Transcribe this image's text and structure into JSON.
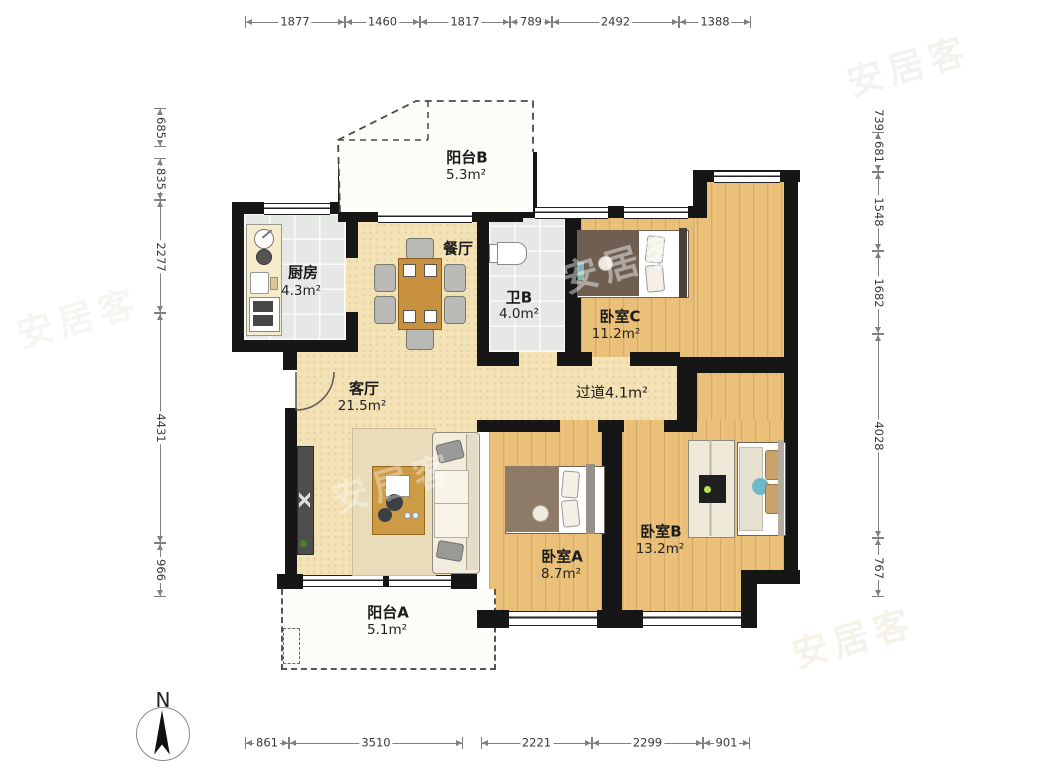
{
  "title": "三室两厅户型图",
  "compass": {
    "label": "N"
  },
  "watermark": {
    "text": "安居客"
  },
  "colors": {
    "wall": "#161616",
    "floor_cream": "#f3e2b6",
    "floor_wood": "#eabf77",
    "floor_tile": "#e6e8e6",
    "accent_teal": "#6fb7c9",
    "dim_line": "#808080"
  },
  "rooms": [
    {
      "id": "balcony_b",
      "name": "阳台B",
      "area": "5.3m²"
    },
    {
      "id": "kitchen",
      "name": "厨房",
      "area": "4.3m²"
    },
    {
      "id": "dining",
      "name": "餐厅",
      "area": ""
    },
    {
      "id": "bath_b",
      "name": "卫B",
      "area": "4.0m²"
    },
    {
      "id": "bedroom_c",
      "name": "卧室C",
      "area": "11.2m²"
    },
    {
      "id": "hallway",
      "name": "过道",
      "area": "4.1m²"
    },
    {
      "id": "living",
      "name": "客厅",
      "area": "21.5m²"
    },
    {
      "id": "bedroom_a",
      "name": "卧室A",
      "area": "8.7m²"
    },
    {
      "id": "bedroom_b",
      "name": "卧室B",
      "area": "13.2m²"
    },
    {
      "id": "balcony_a",
      "name": "阳台A",
      "area": "5.1m²"
    }
  ],
  "dimensions": {
    "top": [
      "1877",
      "1460",
      "1817",
      "789",
      "2492",
      "1388"
    ],
    "left": [
      "685",
      "835",
      "2277",
      "4431",
      "966"
    ],
    "right": [
      "739",
      "681",
      "1548",
      "1682",
      "4028",
      "767"
    ],
    "bottom": [
      "861",
      "3510",
      "2221",
      "2299",
      "901"
    ]
  }
}
